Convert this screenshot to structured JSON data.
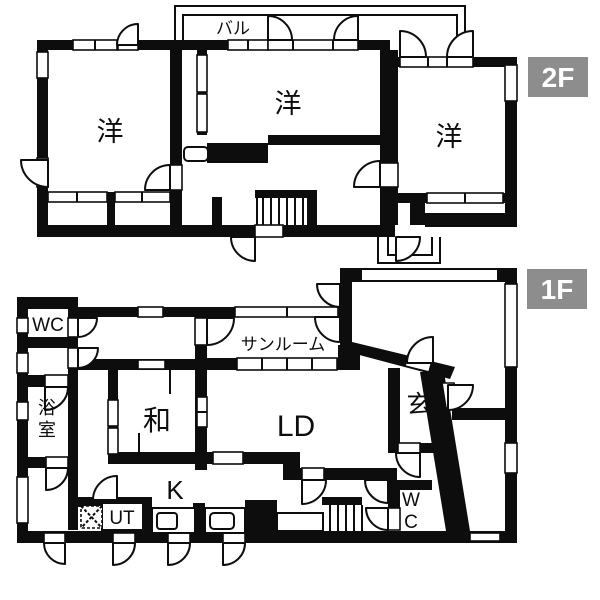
{
  "colors": {
    "wall": "#0d0d0d",
    "bg": "#ffffff",
    "badge_bg": "#8d8d8d",
    "badge_text": "#ffffff"
  },
  "f2": {
    "badge": "2F",
    "balcony": "バル",
    "room_left": "洋",
    "room_center": "洋",
    "room_right": "洋"
  },
  "f1": {
    "badge": "1F",
    "wc_top": "WC",
    "sunroom": "サンルーム",
    "bath": "浴室",
    "washitsu": "和",
    "living_dining": "LD",
    "entrance": "玄",
    "kitchen": "K",
    "utility": "UT",
    "wc_bottom": "WC"
  }
}
